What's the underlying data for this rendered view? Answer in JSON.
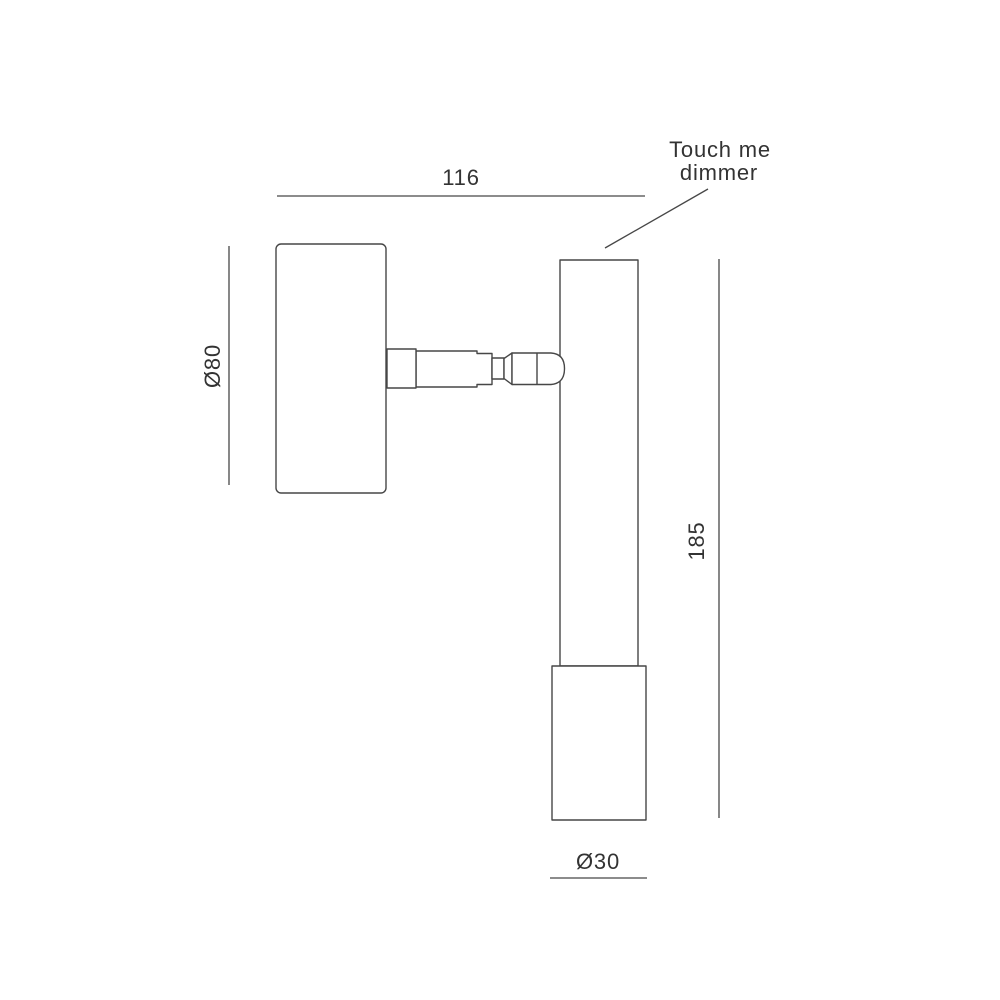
{
  "canvas": {
    "background_color": "#ffffff",
    "line_color": "#474747",
    "text_color": "#333333"
  },
  "drawing": {
    "annotation": {
      "line1": "Touch me",
      "line2": "dimmer"
    },
    "dimensions": {
      "overall_width": "116",
      "head_diameter": "Ø80",
      "body_height": "185",
      "base_diameter": "Ø30"
    }
  }
}
